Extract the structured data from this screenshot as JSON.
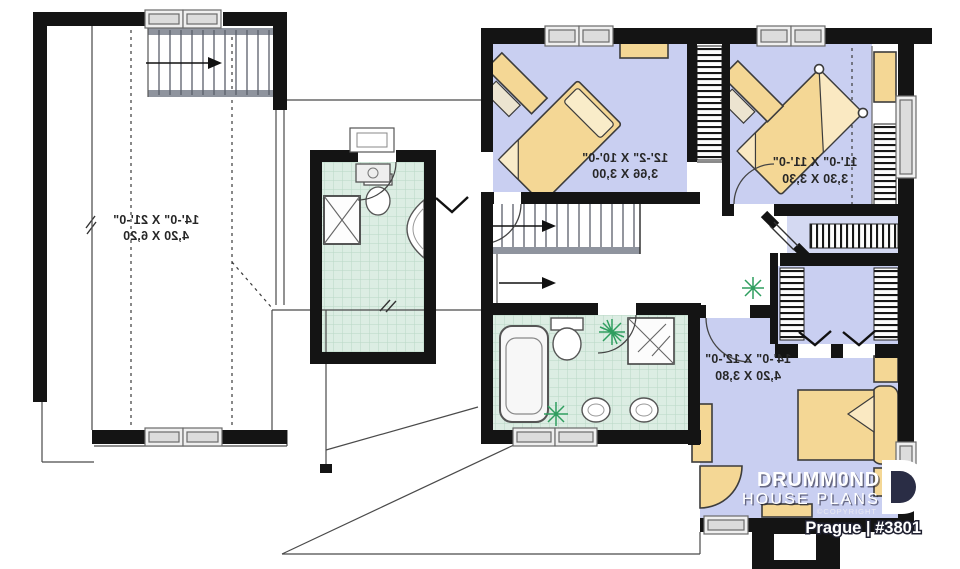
{
  "plan": {
    "brand_line1": "DRUMM0ND",
    "brand_line2": "HOUSE PLANS",
    "copyright": "©COPYRIGHT",
    "title": "Prague | #3801"
  },
  "rooms": [
    {
      "id": "bonus-room",
      "imperial": "14'-0\" X 21'-0\"",
      "metric": "4,20 X 6,20"
    },
    {
      "id": "bedroom-top-left",
      "imperial": "12'-2\" X 10'-0\"",
      "metric": "3,66 X 3,00"
    },
    {
      "id": "bedroom-top-right",
      "imperial": "11'-0\" X 11'-0\"",
      "metric": "3,30 X 3,30"
    },
    {
      "id": "master-bedroom",
      "imperial": "14'-0\" X 12'-0\"",
      "metric": "4,20 X 3,80"
    }
  ],
  "colors": {
    "wall": "#141414",
    "floor_blue": "#c9cff1",
    "tile_green": "#dcede3",
    "furniture_beige": "#f4d795",
    "plant_green": "#2f9e5f",
    "logo_white": "#ffffff"
  }
}
